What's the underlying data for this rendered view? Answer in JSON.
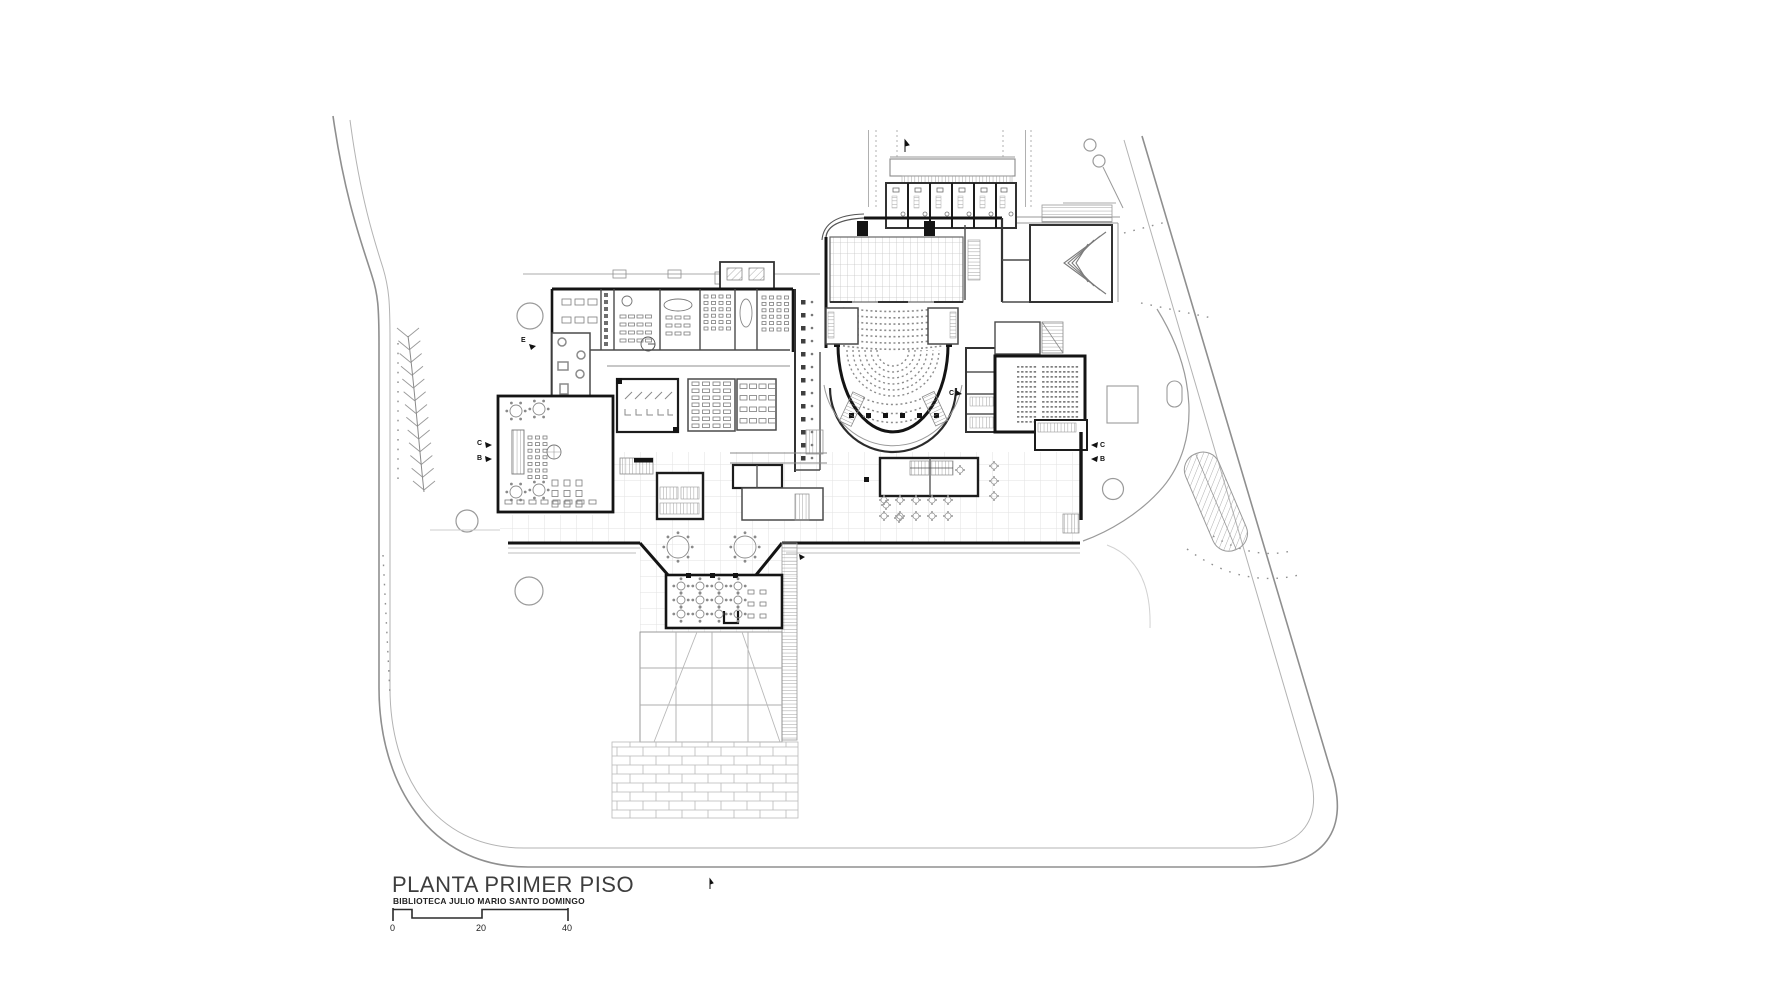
{
  "document": {
    "kind": "architectural-floor-plan",
    "title": "PLANTA PRIMER PISO",
    "subtitle": "BIBLIOTECA JULIO MARIO SANTO DOMINGO"
  },
  "scale_bar": {
    "label_start": "0",
    "label_mid": "20",
    "label_end": "40"
  },
  "section_markers": {
    "e_west": "E",
    "c_west": "C",
    "b_west": "B",
    "c_east": "C",
    "b_east": "B",
    "c_center": "C"
  },
  "colors": {
    "paper": "#ffffff",
    "wall_bold": "#1a1a1a",
    "wall_medium": "#4a4a4a",
    "line_light": "#8f8f8f",
    "site_line": "#9a9a9a",
    "grid_line": "#e2e2e2",
    "seat_tone": "#8d8d8d"
  }
}
